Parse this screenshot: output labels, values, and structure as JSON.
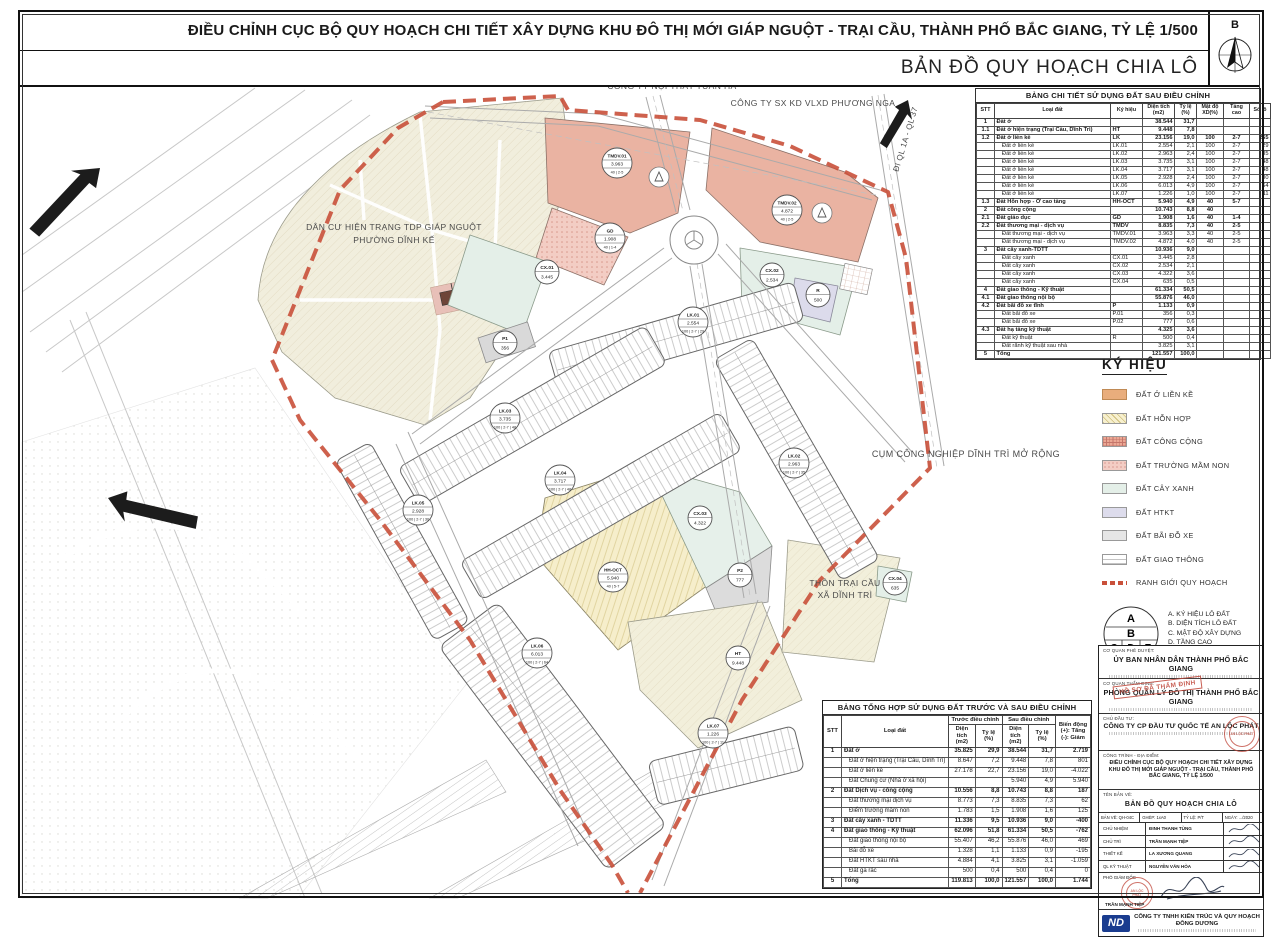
{
  "header": {
    "title": "ĐIỀU CHỈNH CỤC BỘ QUY HOẠCH CHI TIẾT XÂY DỰNG KHU ĐÔ THỊ MỚI GIÁP NGUỘT - TRẠI CẦU, THÀNH PHỐ BẮC GIANG, TỶ LỆ 1/500",
    "subtitle": "BẢN ĐỒ QUY HOẠCH CHIA LÔ",
    "north_label": "B"
  },
  "colors": {
    "boundary_red": "#c9503a",
    "salmon": "#eab3a2",
    "beige": "#f1eedd",
    "yellow_mixed": "#f6eecb",
    "green": "#e4efe8",
    "lavender": "#dcdbeb",
    "parking_gray": "#dcdcdc",
    "lienke_orange": "#e9ad7c"
  },
  "map": {
    "labels": [
      {
        "text": "NISSAN BẮC GIANG",
        "x": 527,
        "y": 77,
        "size": 8.5,
        "rotate": 0
      },
      {
        "text": "CÔNG TY NỘI THẤT TUẤN HÀ",
        "x": 672,
        "y": 89,
        "size": 8.5,
        "rotate": 0
      },
      {
        "text": "CÔNG TY SX KD VLXD PHƯƠNG NGA",
        "x": 813,
        "y": 106,
        "size": 8.5,
        "rotate": 0
      },
      {
        "text": "ĐI QL 1A - QL 37",
        "x": 908,
        "y": 140,
        "size": 8,
        "rotate": -73
      },
      {
        "text": "DÂN CƯ HIỆN TRẠNG TDP GIÁP NGUỘT",
        "x": 394,
        "y": 230,
        "size": 8.5,
        "rotate": 0
      },
      {
        "text": "PHƯỜNG DĨNH KẾ",
        "x": 394,
        "y": 243,
        "size": 8.5,
        "rotate": 0
      },
      {
        "text": "CỤM CÔNG NGHIỆP DĨNH TRÌ MỞ RỘNG",
        "x": 966,
        "y": 457,
        "size": 9,
        "rotate": 0
      },
      {
        "text": "THÔN TRẠI CẦU",
        "x": 845,
        "y": 586,
        "size": 8.5,
        "rotate": 0
      },
      {
        "text": "XÃ DĨNH TRÌ",
        "x": 845,
        "y": 598,
        "size": 8.5,
        "rotate": 0
      }
    ],
    "markers": [
      {
        "id": "TMDV.01",
        "area": "3.963",
        "extra": "40 | 2-5",
        "x": 617,
        "y": 163
      },
      {
        "id": "TMDV.02",
        "area": "4.872",
        "extra": "40 | 2-5",
        "x": 787,
        "y": 210
      },
      {
        "id": "GD",
        "area": "1.908",
        "extra": "40 | 1-4",
        "x": 610,
        "y": 238
      },
      {
        "id": "CX.01",
        "area": "3.445",
        "x": 547,
        "y": 272
      },
      {
        "id": "CX.02",
        "area": "2.534",
        "x": 772,
        "y": 275
      },
      {
        "id": "R",
        "area": "500",
        "x": 818,
        "y": 295
      },
      {
        "id": "LK.01",
        "area": "2.554",
        "extra": "100 | 2-7 | 29",
        "x": 693,
        "y": 322
      },
      {
        "id": "P1",
        "area": "356",
        "x": 505,
        "y": 343
      },
      {
        "id": "LK.03",
        "area": "3.735",
        "extra": "100 | 2-7 | 48",
        "x": 505,
        "y": 418
      },
      {
        "id": "LK.02",
        "area": "2.963",
        "extra": "100 | 2-7 | 35",
        "x": 794,
        "y": 463
      },
      {
        "id": "LK.04",
        "area": "3.717",
        "extra": "100 | 2-7 | 48",
        "x": 560,
        "y": 480
      },
      {
        "id": "LK.05",
        "area": "2.928",
        "extra": "100 | 2-7 | 30",
        "x": 418,
        "y": 510
      },
      {
        "id": "CX.03",
        "area": "4.322",
        "x": 700,
        "y": 518
      },
      {
        "id": "P2",
        "area": "777",
        "x": 740,
        "y": 575
      },
      {
        "id": "HH-OCT",
        "area": "5.940",
        "extra": "40 | 5-7",
        "x": 613,
        "y": 577
      },
      {
        "id": "CX.04",
        "area": "635",
        "x": 895,
        "y": 583
      },
      {
        "id": "LK.06",
        "area": "6.013",
        "extra": "100 | 2-7 | 64",
        "x": 537,
        "y": 653
      },
      {
        "id": "HT",
        "area": "9.448",
        "x": 738,
        "y": 658
      },
      {
        "id": "LK.07",
        "area": "1.226",
        "extra": "100 | 2-7 | 11",
        "x": 713,
        "y": 733
      }
    ]
  },
  "detail_table": {
    "title": "BẢNG CHI TIẾT SỬ DỤNG ĐẤT SAU ĐIỀU CHỈNH",
    "headers": [
      "STT",
      "Loại đất",
      "Ký hiệu",
      "Diện tích\n(m2)",
      "Tỷ lệ\n(%)",
      "Mật độ\nXD(%)",
      "Tầng cao",
      "Số lô"
    ],
    "rows": [
      {
        "b": true,
        "c": [
          "1",
          "Đất ở",
          "",
          "38.544",
          "31,7",
          "",
          "",
          ""
        ]
      },
      {
        "b": true,
        "c": [
          "1.1",
          "Đất ở hiện trạng (Trại Cầu, Dĩnh Trì)",
          "HT",
          "9.448",
          "7,8",
          "",
          "",
          ""
        ]
      },
      {
        "b": true,
        "c": [
          "1.2",
          "Đất ở liền kề",
          "LK",
          "23.156",
          "19,0",
          "100",
          "2-7",
          "265"
        ]
      },
      {
        "c": [
          "",
          "Đất ở liền kề",
          "LK.01",
          "2.554",
          "2,1",
          "100",
          "2-7",
          "29"
        ]
      },
      {
        "c": [
          "",
          "Đất ở liền kề",
          "LK.02",
          "2.963",
          "2,4",
          "100",
          "2-7",
          "35"
        ]
      },
      {
        "c": [
          "",
          "Đất ở liền kề",
          "LK.03",
          "3.735",
          "3,1",
          "100",
          "2-7",
          "48"
        ]
      },
      {
        "c": [
          "",
          "Đất ở liền kề",
          "LK.04",
          "3.717",
          "3,1",
          "100",
          "2-7",
          "48"
        ]
      },
      {
        "c": [
          "",
          "Đất ở liền kề",
          "LK.05",
          "2.928",
          "2,4",
          "100",
          "2-7",
          "30"
        ]
      },
      {
        "c": [
          "",
          "Đất ở liền kề",
          "LK.06",
          "6.013",
          "4,9",
          "100",
          "2-7",
          "64"
        ]
      },
      {
        "c": [
          "",
          "Đất ở liền kề",
          "LK.07",
          "1.226",
          "1,0",
          "100",
          "2-7",
          "11"
        ]
      },
      {
        "b": true,
        "c": [
          "1.3",
          "Đất Hỗn hợp - Ở cao tầng",
          "HH-OCT",
          "5.940",
          "4,9",
          "40",
          "5-7",
          ""
        ]
      },
      {
        "b": true,
        "c": [
          "2",
          "Đất công cộng",
          "",
          "10.743",
          "8,8",
          "40",
          "",
          ""
        ]
      },
      {
        "b": true,
        "c": [
          "2.1",
          "Đất giáo dục",
          "GD",
          "1.908",
          "1,6",
          "40",
          "1-4",
          ""
        ]
      },
      {
        "b": true,
        "c": [
          "2.2",
          "Đất thương mại - dịch vụ",
          "TMDV",
          "8.835",
          "7,3",
          "40",
          "2-5",
          ""
        ]
      },
      {
        "c": [
          "",
          "Đất thương mại - dịch vụ",
          "TMDV.01",
          "3.963",
          "3,3",
          "40",
          "2-5",
          ""
        ]
      },
      {
        "c": [
          "",
          "Đất thương mại - dịch vụ",
          "TMDV.02",
          "4.872",
          "4,0",
          "40",
          "2-5",
          ""
        ]
      },
      {
        "b": true,
        "c": [
          "3",
          "Đất cây xanh-TDTT",
          "",
          "10.936",
          "9,0",
          "",
          "",
          ""
        ]
      },
      {
        "c": [
          "",
          "Đất cây xanh",
          "CX.01",
          "3.445",
          "2,8",
          "",
          "",
          ""
        ]
      },
      {
        "c": [
          "",
          "Đất cây xanh",
          "CX.02",
          "2.534",
          "2,1",
          "",
          "",
          ""
        ]
      },
      {
        "c": [
          "",
          "Đất cây xanh",
          "CX.03",
          "4.322",
          "3,6",
          "",
          "",
          ""
        ]
      },
      {
        "c": [
          "",
          "Đất cây xanh",
          "CX.04",
          "635",
          "0,5",
          "",
          "",
          ""
        ]
      },
      {
        "b": true,
        "c": [
          "4",
          "Đất giao thông - Kỹ thuật",
          "",
          "61.334",
          "50,5",
          "",
          "",
          ""
        ]
      },
      {
        "b": true,
        "c": [
          "4.1",
          "Đất giao thông nội bộ",
          "",
          "55.876",
          "46,0",
          "",
          "",
          ""
        ]
      },
      {
        "b": true,
        "c": [
          "4.2",
          "Đất bãi đỗ xe tĩnh",
          "P",
          "1.133",
          "0,9",
          "",
          "",
          ""
        ]
      },
      {
        "c": [
          "",
          "Đất bãi đỗ xe",
          "P.01",
          "356",
          "0,3",
          "",
          "",
          ""
        ]
      },
      {
        "c": [
          "",
          "Đất bãi đỗ xe",
          "P.02",
          "777",
          "0,6",
          "",
          "",
          ""
        ]
      },
      {
        "b": true,
        "c": [
          "4.3",
          "Đất hạ tầng kỹ thuật",
          "",
          "4.325",
          "3,6",
          "",
          "",
          ""
        ]
      },
      {
        "c": [
          "",
          "Đất kỹ thuật",
          "R",
          "500",
          "0,4",
          "",
          "",
          ""
        ]
      },
      {
        "c": [
          "",
          "Đất rãnh kỹ thuật sau nhà",
          "",
          "3.825",
          "3,1",
          "",
          "",
          ""
        ]
      },
      {
        "b": true,
        "c": [
          "5",
          "Tổng",
          "",
          "121.557",
          "100,0",
          "",
          "",
          ""
        ]
      }
    ]
  },
  "summary_table": {
    "title": "BẢNG TỔNG HỢP SỬ DỤNG ĐẤT TRƯỚC VÀ SAU ĐIỀU CHỈNH",
    "col_stt": "STT",
    "col_loai": "Loại đất",
    "group1": "Trước điều chỉnh",
    "group2": "Sau điều chỉnh",
    "group3": "Biến động\n(+): Tăng\n(-): Giảm",
    "subs": [
      "Diện tích\n(m2)",
      "Tỷ lệ\n(%)",
      "Diện tích\n(m2)",
      "Tỷ lệ\n(%)"
    ],
    "rows": [
      {
        "b": true,
        "c": [
          "1",
          "Đất ở",
          "35.825",
          "29,9",
          "38.544",
          "31,7",
          "2.719"
        ]
      },
      {
        "c": [
          "",
          "Đất ở hiện trạng (Trại Cầu, Dĩnh Trì)",
          "8.647",
          "7,2",
          "9.448",
          "7,8",
          "801"
        ]
      },
      {
        "c": [
          "",
          "Đất ở liền kề",
          "27.178",
          "22,7",
          "23.156",
          "19,0",
          "-4.022"
        ]
      },
      {
        "c": [
          "",
          "Đất Chung cư (Nhà ở xã hội)",
          "",
          "",
          "5.940",
          "4,9",
          "5.940"
        ]
      },
      {
        "b": true,
        "c": [
          "2",
          "Đất Dịch vụ - công cộng",
          "10.556",
          "8,8",
          "10.743",
          "8,8",
          "187"
        ]
      },
      {
        "c": [
          "",
          "Đất thương mại dịch vụ",
          "8.773",
          "7,3",
          "8.835",
          "7,3",
          "62"
        ]
      },
      {
        "c": [
          "",
          "Điểm trường mầm non",
          "1.783",
          "1,5",
          "1.908",
          "1,6",
          "125"
        ]
      },
      {
        "b": true,
        "c": [
          "3",
          "Đất cây xanh - TDTT",
          "11.336",
          "9,5",
          "10.936",
          "9,0",
          "-400"
        ]
      },
      {
        "b": true,
        "c": [
          "4",
          "Đất giao thông - Kỹ thuật",
          "62.096",
          "51,8",
          "61.334",
          "50,5",
          "-762"
        ]
      },
      {
        "c": [
          "",
          "Đất giao thông nội bộ",
          "55.407",
          "46,2",
          "55.876",
          "46,0",
          "469"
        ]
      },
      {
        "c": [
          "",
          "Bãi đỗ xe",
          "1.328",
          "1,1",
          "1.133",
          "0,9",
          "-195"
        ]
      },
      {
        "c": [
          "",
          "Đất HTKT sau nhà",
          "4.884",
          "4,1",
          "3.825",
          "3,1",
          "-1.059"
        ]
      },
      {
        "c": [
          "",
          "Đất ga rác",
          "500",
          "0,4",
          "500",
          "0,4",
          "0"
        ]
      },
      {
        "b": true,
        "c": [
          "5",
          "Tổng",
          "119.813",
          "100,0",
          "121.557",
          "100,0",
          "1.744"
        ]
      }
    ]
  },
  "legend": {
    "title": "KÝ HIỆU",
    "items": [
      {
        "key": "lienke",
        "label": "ĐẤT Ở LIỀN KỀ"
      },
      {
        "key": "honhop",
        "label": "ĐẤT HỖN HỢP"
      },
      {
        "key": "congcong",
        "label": "ĐẤT CÔNG CỘNG"
      },
      {
        "key": "mamnon",
        "label": "ĐẤT TRƯỜNG MẦM NON"
      },
      {
        "key": "cayxanh",
        "label": "ĐẤT CÂY XANH"
      },
      {
        "key": "htkt",
        "label": "ĐẤT HTKT"
      },
      {
        "key": "baidoxe",
        "label": "ĐẤT BÃI ĐỖ XE"
      },
      {
        "key": "giaothong",
        "label": "ĐẤT GIAO THÔNG"
      },
      {
        "key": "ranhgioi",
        "label": "RANH GIỚI QUY HOẠCH"
      }
    ],
    "circle1": {
      "letters": [
        "A",
        "B",
        "C",
        "D",
        "E"
      ],
      "lines": [
        "A. KÝ HIỆU LÔ ĐẤT",
        "B. DIỆN TÍCH LÔ ĐẤT",
        "C. MẬT ĐỘ XÂY DỰNG",
        "D. TẦNG CAO",
        "E. SỐ LÔ LIỀN KỀ"
      ]
    },
    "circle2": {
      "letters": [
        "A",
        "B"
      ],
      "lines": [
        "A: Lô đất",
        "B: Diện tích"
      ]
    }
  },
  "title_block": {
    "approve_label": "CƠ QUAN PHÊ DUYỆT:",
    "approve": "ỦY BAN NHÂN DÂN THÀNH PHỐ BẮC GIANG",
    "verify_label": "CƠ QUAN THẨM ĐỊNH:",
    "verify": "PHÒNG QUẢN LÝ ĐÔ THỊ THÀNH PHỐ BẮC GIANG",
    "investor_label": "CHỦ ĐẦU TƯ:",
    "investor": "CÔNG TY CP ĐẦU TƯ QUỐC TẾ AN LỘC PHÁT",
    "project_label": "CÔNG TRÌNH - ĐỊA ĐIỂM:",
    "project": "ĐIỀU CHỈNH CỤC BỘ QUY HOẠCH CHI TIẾT XÂY DỰNG KHU ĐÔ THỊ MỚI GIÁP NGUỘT - TRẠI CẦU, THÀNH PHỐ BẮC GIANG, TỶ LỆ 1/500",
    "drawing_label": "TÊN BẢN VẼ:",
    "drawing": "BẢN ĐỒ QUY HOẠCH CHIA LÔ",
    "meta": [
      "BẢN VẼ: QH-04C",
      "GHÉP: 1xA0",
      "TỶ LỆ: P/T",
      "NGÀY: .../2020"
    ],
    "roles": [
      {
        "label": "CHỦ NHIỆM",
        "name": "ĐINH THANH TÙNG"
      },
      {
        "label": "CHỦ TRÌ",
        "name": "TRẦN MẠNH TIỆP"
      },
      {
        "label": "THIẾT KẾ",
        "name": "LA XƯƠNG QUANG"
      },
      {
        "label": "QL KỸ THUẬT",
        "name": "NGUYỄN VĂN HÒA"
      }
    ],
    "director_label": "PHÓ GIÁM ĐỐC",
    "director_name": "TRẦN MẠNH TIỆP",
    "company": "CÔNG TY TNHH KIẾN TRÚC VÀ QUY HOẠCH ĐÔNG DƯƠNG",
    "stamp": "HỒ SƠ ĐÃ THẨM ĐỊNH",
    "stamp_circle": "AN LỘC PHÁT",
    "logo": "ND"
  }
}
